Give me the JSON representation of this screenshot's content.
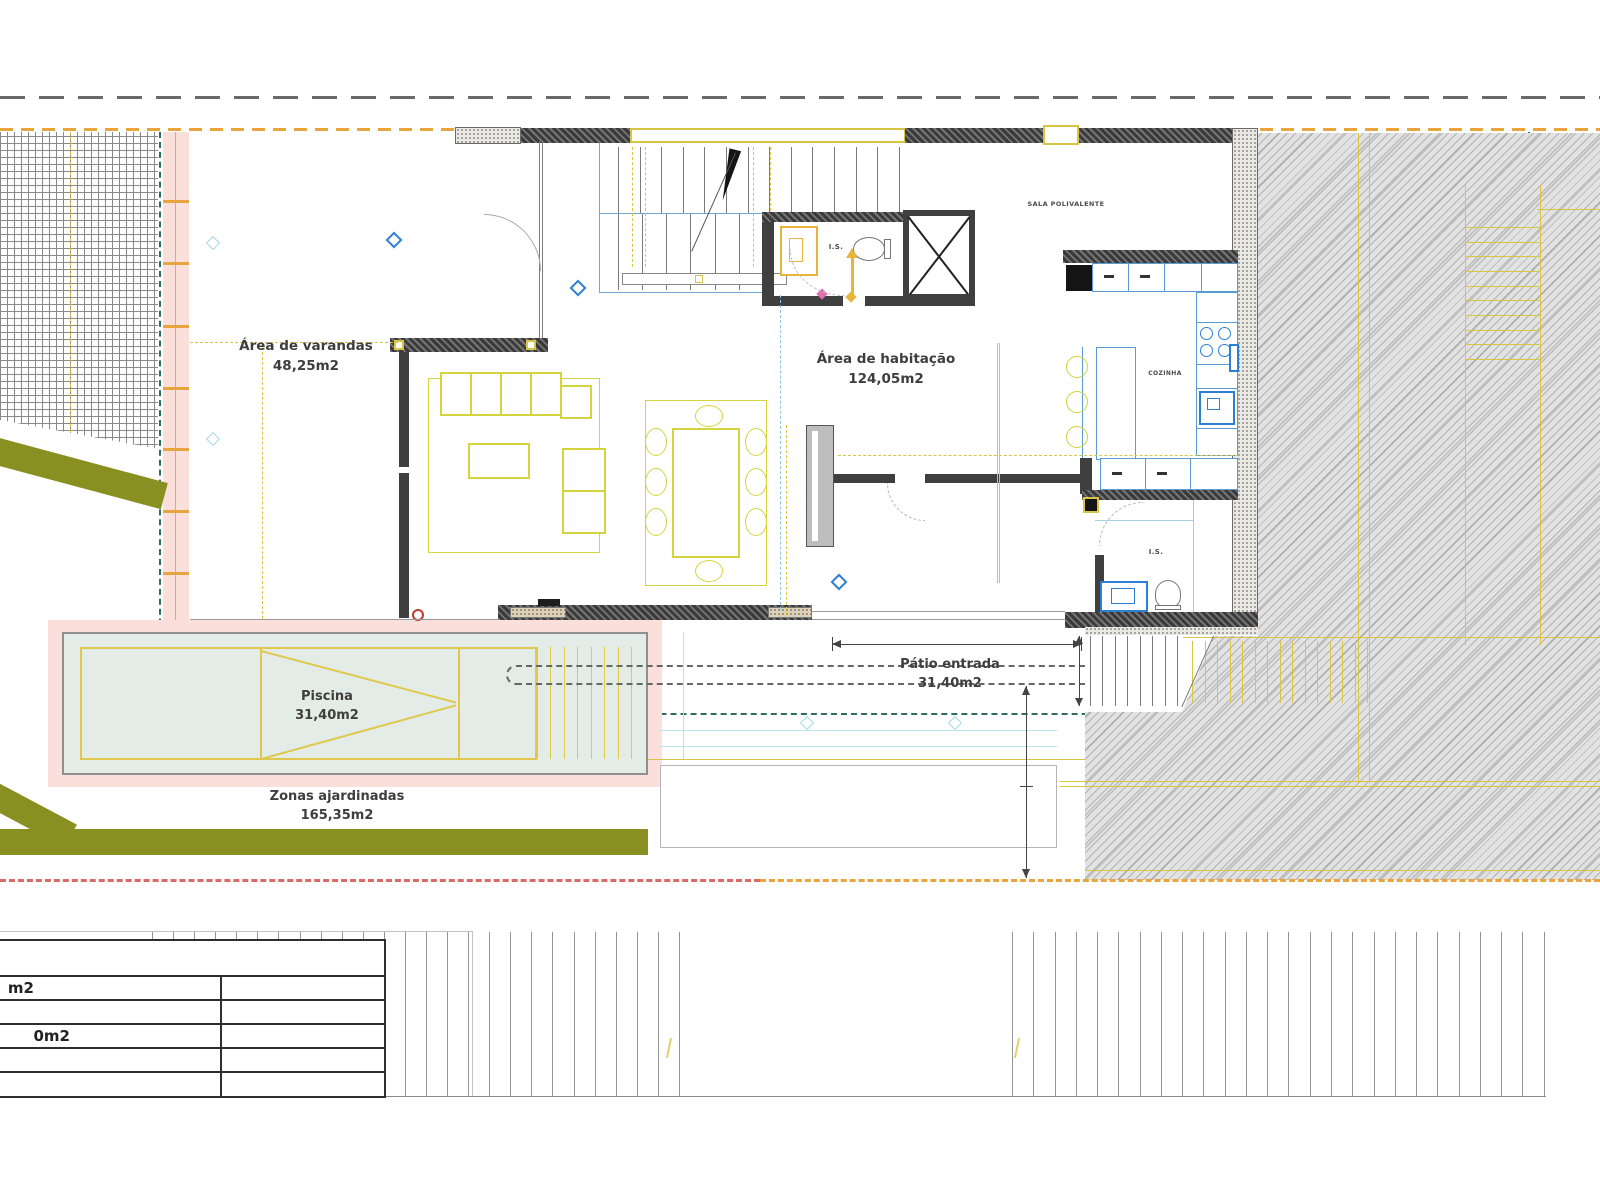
{
  "areas": {
    "varandas": {
      "name": "Área de varandas",
      "value": "48,25m2"
    },
    "habitacao": {
      "name": "Área de habitação",
      "value": "124,05m2"
    },
    "piscina": {
      "name": "Piscina",
      "value": "31,40m2"
    },
    "ajardinadas": {
      "name": "Zonas ajardinadas",
      "value": "165,35m2"
    },
    "patio": {
      "name": "Pátio entrada",
      "value": "31,40m2"
    }
  },
  "rooms": {
    "sala_polivalente": "SALA POLIVALENTE",
    "cozinha": "COZINHA",
    "wc": "I.S.",
    "bathroom": "I.S."
  },
  "legend": {
    "rows": [
      "m2",
      "",
      "0m2",
      "",
      ""
    ]
  },
  "colors": {
    "boundary_gray": "#6a6a6a",
    "boundary_orange": "#e8a53e",
    "property_teal": "#2f6b5e",
    "boundary_red": "#d96a66",
    "highlight_pink": "#fadfdb",
    "pool_water": "#e3ece7",
    "drawing_yellow": "#d9c545",
    "furniture_yellow": "#d4d43e",
    "fixture_blue": "#2b7fd4",
    "cabinet_blue": "#5b9bd5",
    "garden_olive": "#8a8f22",
    "wall_dark": "#3f3f3f"
  }
}
